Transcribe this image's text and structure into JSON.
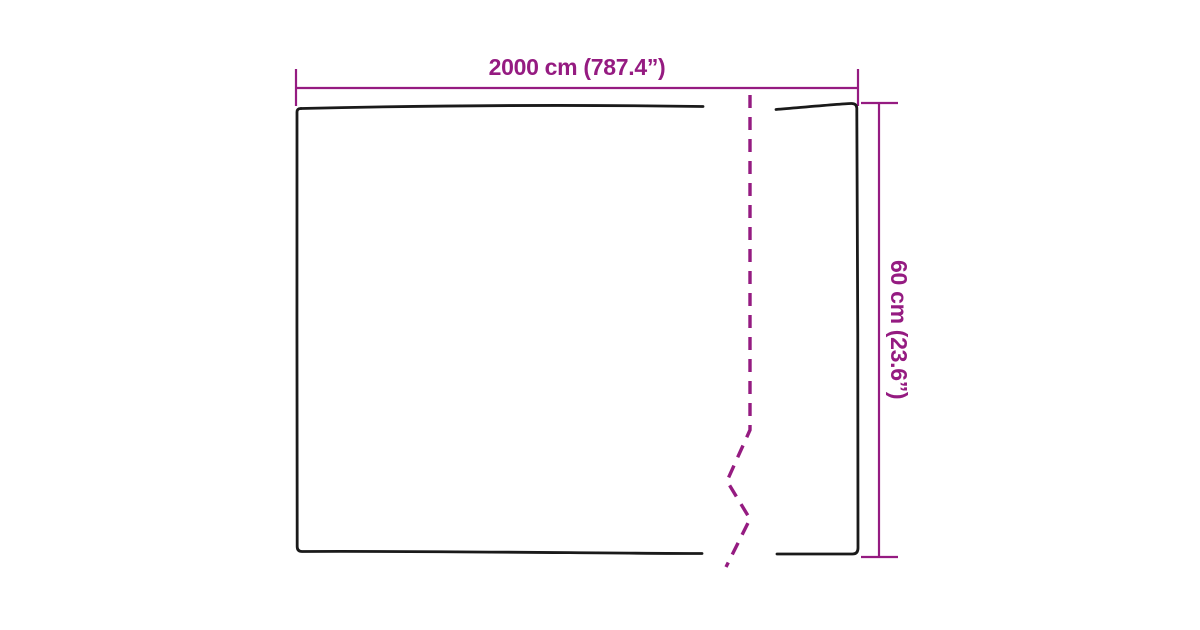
{
  "diagram": {
    "type": "product-dimension-diagram",
    "subject": "flat sheet outline with fold break line",
    "colors": {
      "outline": "#1a1a1a",
      "dimension": "#951b81",
      "background": "#ffffff"
    },
    "width_dimension": {
      "label": "2000 cm (787.4”)",
      "value_cm": 2000,
      "value_inches": 787.4
    },
    "height_dimension": {
      "label": "60 cm (23.6”)",
      "value_cm": 60,
      "value_inches": 23.6
    }
  }
}
